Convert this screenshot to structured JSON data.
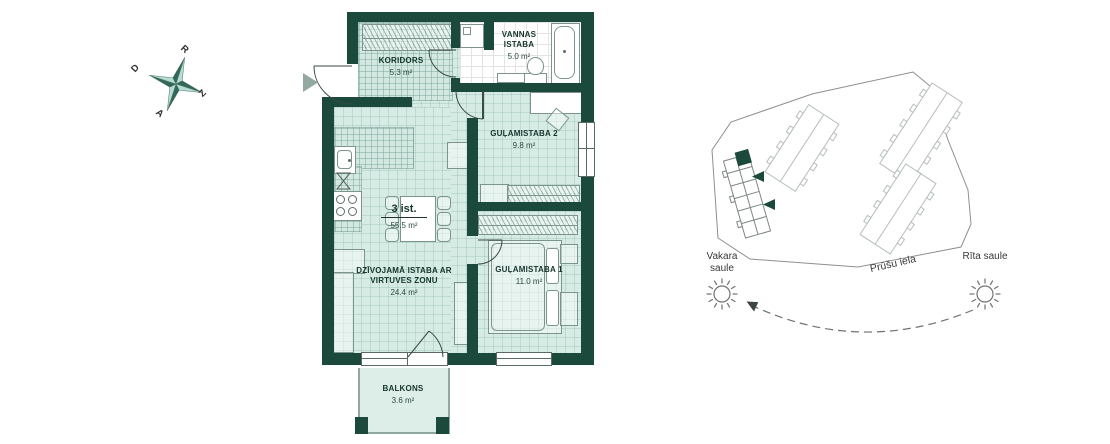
{
  "colors": {
    "wall": "#1B4A3D",
    "floor": "#D6EBE4",
    "bath_floor": "#FFFFFF",
    "furniture_line": "#7D948C",
    "site_line": "#8B918E",
    "highlight_unit": "#1B4A3D"
  },
  "floorplan": {
    "summary": {
      "rooms": "3 ist.",
      "area": "55.5 m²"
    },
    "rooms": [
      {
        "id": "koridors",
        "name": "KORIDORS",
        "area": "5.3 m²"
      },
      {
        "id": "vannas",
        "name": "VANNAS ISTABA",
        "area": "5.0 m²"
      },
      {
        "id": "gulamistaba2",
        "name": "GUĻAMISTABA 2",
        "area": "9.8 m²"
      },
      {
        "id": "gulamistaba1",
        "name": "GUĻAMISTABA 1",
        "area": "11.0 m²"
      },
      {
        "id": "dzivojama",
        "name": "DZĪVOJAMĀ ISTABA AR VIRTUVES ZONU",
        "area": "24.4 m²"
      },
      {
        "id": "balkons",
        "name": "BALKONS",
        "area": "3.6 m²"
      }
    ],
    "compass": {
      "west": "R",
      "north": "Z",
      "east": "A",
      "south": "D"
    }
  },
  "site": {
    "evening_sun": "Vakara saule",
    "street": "Prūšu iela",
    "morning_sun": "Rīta saule"
  }
}
